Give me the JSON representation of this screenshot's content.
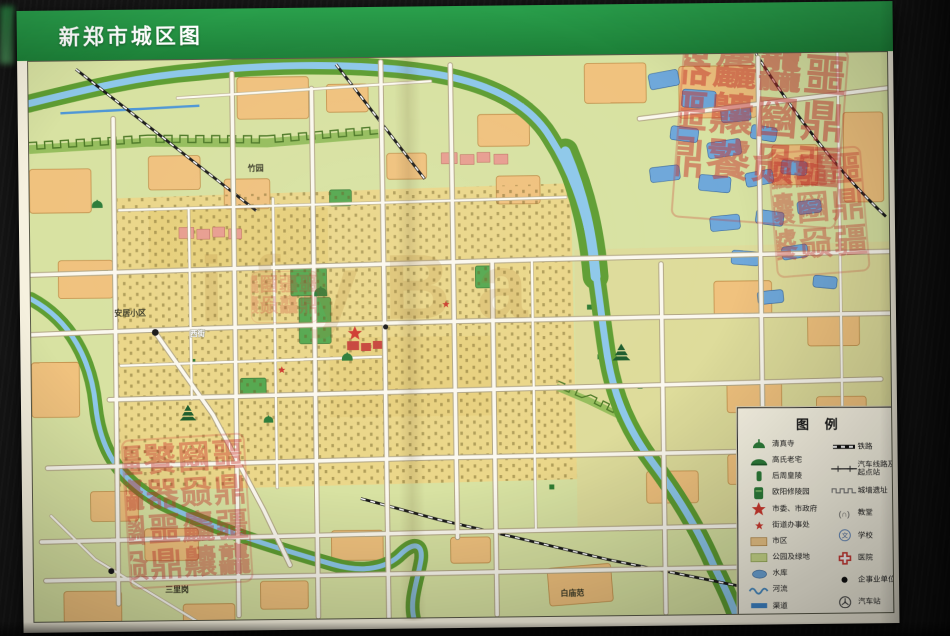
{
  "page": {
    "title": "新郑市城区图"
  },
  "legend": {
    "title": "图  例",
    "left": [
      {
        "icon": "mosque",
        "label": "清真寺"
      },
      {
        "icon": "old-house",
        "label": "高氏老宅"
      },
      {
        "icon": "tomb",
        "label": "后周皇陵"
      },
      {
        "icon": "mausoleum",
        "label": "欧阳修陵园"
      },
      {
        "icon": "star-big",
        "label": "市委、市政府"
      },
      {
        "icon": "star-small",
        "label": "街道办事处"
      },
      {
        "icon": "urban",
        "label": "市区"
      },
      {
        "icon": "park",
        "label": "公园及绿地"
      },
      {
        "icon": "reservoir",
        "label": "水库"
      },
      {
        "icon": "river",
        "label": "河流"
      },
      {
        "icon": "canal",
        "label": "渠道"
      }
    ],
    "right": [
      {
        "icon": "railway",
        "label": "铁路"
      },
      {
        "icon": "busroute",
        "label": "汽车线路及起点站"
      },
      {
        "icon": "wall",
        "label": "城墙遗址"
      },
      {
        "icon": "church",
        "label": "教堂"
      },
      {
        "icon": "school",
        "label": "学校"
      },
      {
        "icon": "hospital",
        "label": "医院"
      },
      {
        "icon": "enterprise",
        "label": "企事业单位"
      },
      {
        "icon": "bus-station",
        "label": "汽车站"
      }
    ]
  },
  "map_labels": {
    "sanligang": "三里岗",
    "baimiaofan": "白庙范",
    "zhuyuan": "竹园",
    "anju": "安居小区",
    "xijie": "西街"
  },
  "watermark": {
    "site_text": "ifyBa",
    "seal_glyphs": "噩鼎疆龘圝赑麤齉饕器"
  },
  "colors": {
    "header_green": "#23923f",
    "map_yellow": "#ebd78a",
    "water_blue": "#8ec8ea",
    "stamp_red": "#cc3a33"
  }
}
